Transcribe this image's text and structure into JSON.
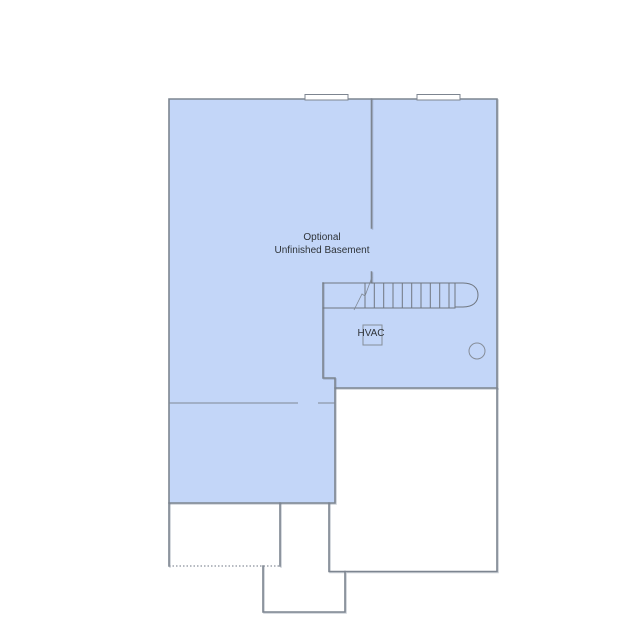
{
  "plan": {
    "labels": {
      "room_line1": "Optional",
      "room_line2": "Unfinished Basement",
      "hvac": "HVAC"
    },
    "colors": {
      "basement_fill": "#c3d6f8",
      "wall_stroke": "#7d8590",
      "thin_line_stroke": "#7f8894",
      "label_color": "#2e3338",
      "background": "#ffffff"
    },
    "features": {
      "window_count": 2,
      "stair_tread_count": 10
    }
  }
}
